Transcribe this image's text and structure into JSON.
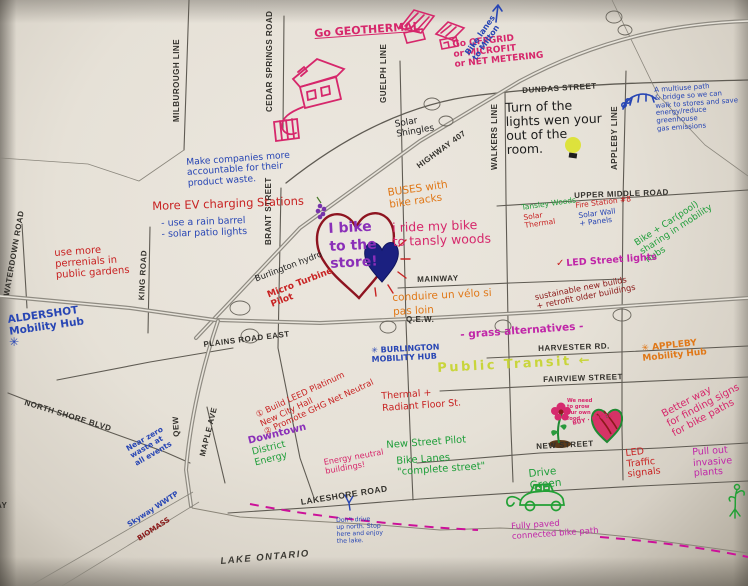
{
  "palette": {
    "paper": "#e9e5dd",
    "paper_edge": "#aba496",
    "road": "#5f5b53",
    "road_label": "#33312c",
    "marker_pink": "#d6276b",
    "marker_red": "#c82323",
    "marker_blue": "#2846b4",
    "marker_orange": "#e07818",
    "marker_green": "#1f9e3a",
    "marker_purple": "#8a2fb8",
    "marker_magenta": "#c026a8",
    "marker_dark_red": "#8b1a1a",
    "highlighter_lime": "#c6d42b",
    "marker_black": "#1c1c1c",
    "heart_navy": "#1b2080",
    "bulb_yellow": "#dde23c"
  },
  "roads": [
    {
      "text": "MILBUROUGH LINE"
    },
    {
      "text": "CEDAR SPRINGS ROAD"
    },
    {
      "text": "GUELPH LINE"
    },
    {
      "text": "DUNDAS STREET"
    },
    {
      "text": "WALKERS LINE"
    },
    {
      "text": "APPLEBY LINE"
    },
    {
      "text": "HIGHWAY 407"
    },
    {
      "text": "BRANT STREET"
    },
    {
      "text": "UPPER MIDDLE ROAD"
    },
    {
      "text": "MAINWAY"
    },
    {
      "text": "Q.E.W."
    },
    {
      "text": "PLAINS ROAD EAST"
    },
    {
      "text": "HARVESTER RD."
    },
    {
      "text": "FAIRVIEW STREET"
    },
    {
      "text": "WATERDOWN ROAD"
    },
    {
      "text": "KING ROAD"
    },
    {
      "text": "NORTH SHORE BLVD"
    },
    {
      "text": "QEW"
    },
    {
      "text": "MAPLE AVE"
    },
    {
      "text": "NEW STREET"
    },
    {
      "text": "LAKESHORE ROAD"
    },
    {
      "text": "LAKE ONTARIO"
    },
    {
      "text": "AY"
    }
  ],
  "annotations": [
    {
      "text": "Go GEOTHERMAL"
    },
    {
      "text": "Go OFFGRID\nor MICROFIT\nor NET METERING"
    },
    {
      "text": "Bike lanes\nto Milton"
    },
    {
      "text": "A multiuse path\n& bridge so we can\nwalk to stores and save\nenergy/reduce greenhouse\ngas emissions"
    },
    {
      "text": "Turn of the\nlights wen your\nout of the\nroom."
    },
    {
      "text": "Solar\nShingles"
    },
    {
      "text": "Make companies more\naccountable for their\nproduct waste."
    },
    {
      "text": "More EV charging Stations"
    },
    {
      "text": "- use a rain barrel\n- solar patio lights"
    },
    {
      "text": "I bike\nto the\nstore!"
    },
    {
      "text": "Burlington hydro"
    },
    {
      "text": "Micro Turbine\nPilot"
    },
    {
      "text": "BUSES with\nbike racks"
    },
    {
      "text": "i ride my bike\nto tansly woods"
    },
    {
      "text": "Tansley Woods"
    },
    {
      "text": "Solar\nThermal"
    },
    {
      "text": "Fire Station #8"
    },
    {
      "text": "Solar Wall\n+ Panels"
    },
    {
      "text": "Bike + Car(pool)\nsharing in mobility\nhubs"
    },
    {
      "text": "✓"
    },
    {
      "text": "LED Street lights"
    },
    {
      "text": "sustainable new builds\n+ retrofit older buildings"
    },
    {
      "text": "conduire un vélo si\npas loin"
    },
    {
      "text": "use more\nperrenials in\npublic gardens"
    },
    {
      "text": "ALDERSHOT\nMobility Hub"
    },
    {
      "text": "✳"
    },
    {
      "text": "- grass alternatives -"
    },
    {
      "text": "✳ BURLINGTON\nMOBILITY HUB"
    },
    {
      "text": "Public Transit ←"
    },
    {
      "text": "① Build LEED Platinum\nNew City Hall\n② Promote GHG Net Neutral"
    },
    {
      "text": "Downtown"
    },
    {
      "text": "District\nEnergy"
    },
    {
      "text": "Thermal +\nRadiant Floor St."
    },
    {
      "text": "Energy neutral\nbuildings!"
    },
    {
      "text": "New Street Pilot"
    },
    {
      "text": "Bike Lanes\n\"complete street\""
    },
    {
      "text": "✳ APPLEBY\nMobility Hub"
    },
    {
      "text": "Better way\nfor finding signs\nfor bike paths"
    },
    {
      "text": "We need\nto grow\nour own\nfood"
    },
    {
      "text": "BUY · LOCAL"
    },
    {
      "text": "LED\nTraffic\nsignals"
    },
    {
      "text": "Pull out\ninvasive\nplants"
    },
    {
      "text": "Drive\nGreen"
    },
    {
      "text": "Near zero\nwaste at\nall events"
    },
    {
      "text": "Skyway WWTP"
    },
    {
      "text": "BIOMASS"
    },
    {
      "text": "Fully paved\nconnected bike path"
    },
    {
      "text": "Don't drive\nup north. Stop\nhere and enjoy\nthe lake."
    }
  ],
  "drawings": {
    "geothermal_house": "pink house sketch with ground-loop coil",
    "offgrid_houses": "pink houses with solar-panel roofs",
    "bridge_doodle": "blue multiuse bridge sketch",
    "lightbulb": "yellow lightbulb",
    "heart_outline": "dark red heart around 'I bike to the store'",
    "filled_heart": "navy filled heart with red rays",
    "grapes_doodle": "purple berry cluster",
    "flower_and_heart": "flower in soil beside striped heart",
    "electric_car": "green electric car with plug cord",
    "plant_roots": "green plant pulled with roots",
    "bike_path_dashes": "magenta dashed bike path along lakeshore",
    "milton_arrow": "blue arrow pointing north",
    "lakeshore_pointer": "small blue mark on lakeshore"
  }
}
